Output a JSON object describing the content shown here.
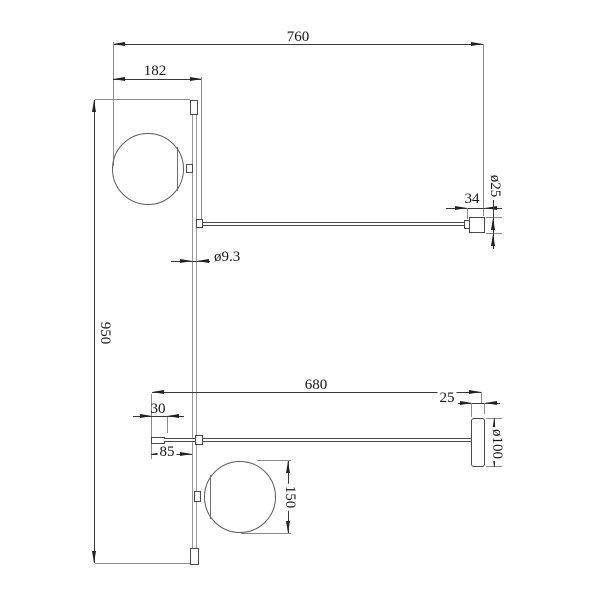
{
  "drawing": {
    "dimensions": {
      "overall_width": "760",
      "sphere_offset_top": "182",
      "overall_height": "950",
      "rod_diameter": "ø9.3",
      "socket_length": "34",
      "socket_diameter": "ø25",
      "lower_arm_length": "680",
      "canopy_thickness": "25",
      "canopy_diameter": "ø100",
      "tip_length": "30",
      "tip_to_rod": "85",
      "sphere_diameter": "150"
    }
  }
}
